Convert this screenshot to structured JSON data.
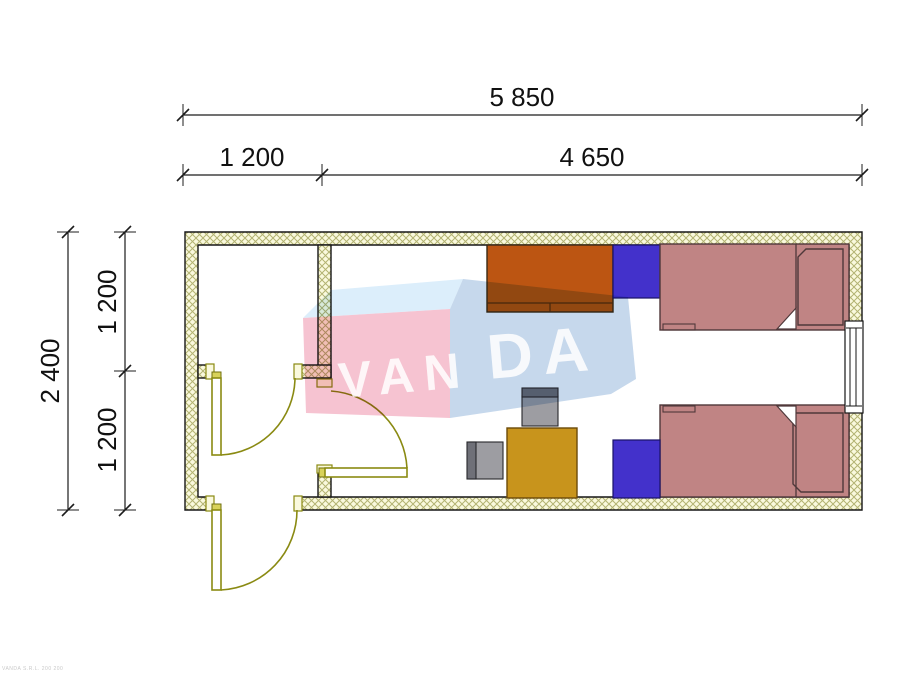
{
  "dimensions": {
    "total_width": "5 850",
    "left_section_width": "1 200",
    "right_section_width": "4 650",
    "total_depth": "2 400",
    "upper_section_depth": "1 200",
    "lower_section_depth": "1 200"
  },
  "watermark": {
    "text_left": "VAN",
    "text_right": "DA",
    "colors": {
      "pink_face": "#f6c3d1",
      "blue_top_face": "#dceefb",
      "blue_side_face": "#c6d8ec",
      "letters": "#ffffff"
    }
  },
  "plan": {
    "type": "floor-plan",
    "rooms": [
      "vestibule",
      "entry",
      "main-room"
    ],
    "wall_fill": "#faf9dd",
    "wall_hatch_color": "#b3b372",
    "door_symbol_color": "#8a8a12",
    "furniture_colors": {
      "wardrobe": "#bc5512",
      "bedside_cabinet": "#4331cb",
      "bed": "#c08484",
      "desk": "#c8941c",
      "chair_seat": "#9d9da2",
      "chair_back": "#6f7078"
    },
    "furniture_items": [
      "wardrobe",
      "bedside-cabinet-1",
      "bed-1",
      "bed-2",
      "bedside-cabinet-2",
      "desk",
      "chair-1",
      "chair-2"
    ],
    "openings": [
      "interior-door-vestibule",
      "interior-door-main-room",
      "exterior-entrance-door",
      "window-right-wall"
    ]
  },
  "footer": {
    "fine_print": "VANDA S.R.L. 200 200"
  }
}
